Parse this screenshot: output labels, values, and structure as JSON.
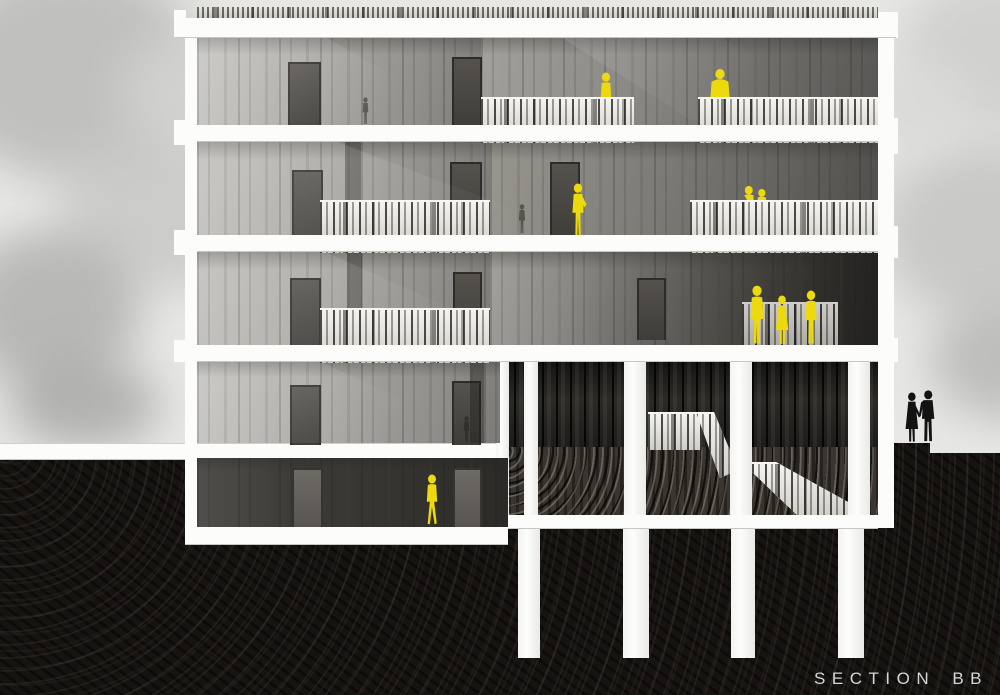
{
  "meta": {
    "caption": "SECTION BB",
    "drawing_type": "architectural building section"
  },
  "palette": {
    "figure_yellow": "#ecd90e",
    "silhouette_black": "#131313",
    "earth_black": "#161310",
    "sky_gray": "#e7e7e5",
    "slab_white": "#fcfcfb",
    "caption_gray": "#d6d6d6"
  },
  "figures": [
    {
      "id": "top-terrace-person-left",
      "color": "yellow",
      "pose": "standing behind railing"
    },
    {
      "id": "top-terrace-person-right",
      "color": "yellow",
      "pose": "standing behind railing"
    },
    {
      "id": "second-floor-woman",
      "color": "yellow",
      "pose": "standing, hand on hip"
    },
    {
      "id": "second-floor-balcony-couple",
      "color": "yellow",
      "pose": "pair behind railing"
    },
    {
      "id": "third-floor-group-of-three",
      "color": "yellow",
      "pose": "three people standing"
    },
    {
      "id": "basement-walker",
      "color": "yellow",
      "pose": "walking"
    },
    {
      "id": "ground-couple-silhouette",
      "color": "black",
      "pose": "couple holding hands at grade"
    }
  ],
  "structure": {
    "levels": 5,
    "foundation_piles": 4,
    "balcony_railings": 6,
    "stair_flights": 2
  }
}
